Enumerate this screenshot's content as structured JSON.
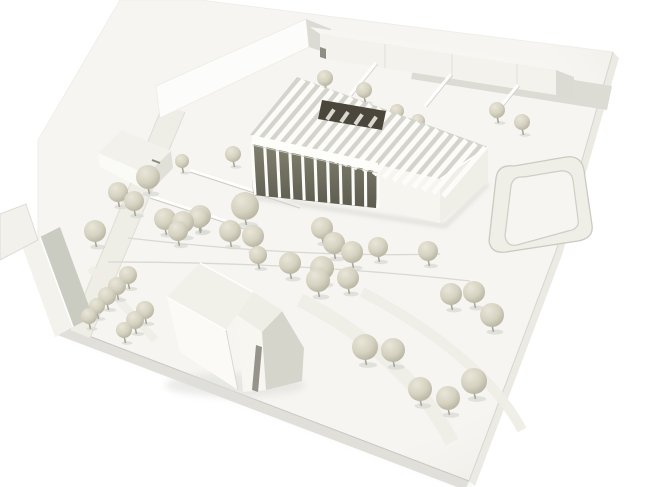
{
  "scene": {
    "kind": "photograph-of-white-architectural-site-model",
    "palette": {
      "background": "#ffffff",
      "board": "#f6f5f1",
      "board_edge_right": "#ebeae3",
      "board_edge_bottom": "#e0dfda",
      "board_edge_left": "#e6e5df",
      "board_line": "#c9c8c3",
      "shadow": "#cfcfca",
      "white_face": "#fafaf7",
      "lit_face": "#fcfcfa",
      "shaded_face": "#e9e8e1",
      "gray_face": "#dbdad3",
      "dark_gray_face": "#cbccc1",
      "glass_top": "#83826f",
      "glass_bottom": "#5c5b4f",
      "opening": "#4a463c",
      "tooth": "#d9d8d0",
      "road": "#dcdbd4",
      "path": "#eeede6",
      "path_line": "#d9d8d1",
      "louver": "#fcfcf9",
      "louver_gap": "#d5d4cc",
      "curb": "#e0dfd8",
      "trunk": "#a8a69a",
      "tree_shadow": "#dadad4",
      "tree_light": "#e9e6d9",
      "tree_mid": "#d5d2c1",
      "tree_dark": "#b1ae9b",
      "slot_dark": "#96948a",
      "window_slot": "#8a897e"
    },
    "board": {
      "top": [
        [
          200,
          0
        ],
        [
          613,
          52
        ],
        [
          556,
          251
        ],
        [
          469,
          481
        ],
        [
          60,
          325
        ],
        [
          38,
          260
        ],
        [
          38,
          140
        ],
        [
          120,
          0
        ]
      ],
      "bottom_face": [
        [
          60,
          325
        ],
        [
          469,
          481
        ],
        [
          465,
          490
        ],
        [
          55,
          334
        ]
      ],
      "right_face": [
        [
          613,
          52
        ],
        [
          556,
          251
        ],
        [
          469,
          481
        ],
        [
          475,
          486
        ],
        [
          562,
          255
        ],
        [
          619,
          58
        ]
      ],
      "left_face": [
        [
          38,
          260
        ],
        [
          60,
          325
        ],
        [
          55,
          334
        ],
        [
          33,
          269
        ]
      ],
      "bottom_edge_line": [
        [
          60,
          325
        ],
        [
          469,
          481
        ]
      ],
      "right_edge_line": [
        [
          613,
          52
        ],
        [
          556,
          251
        ],
        [
          469,
          481
        ]
      ],
      "drop_shadow": "M 60 328 L 469 484"
    },
    "roads": {
      "top_band": [
        [
          416,
          55
        ],
        [
          612,
          86
        ],
        [
          607,
          110
        ],
        [
          411,
          79
        ]
      ],
      "left_band": [
        [
          163,
          105
        ],
        [
          185,
          112
        ],
        [
          90,
          338
        ],
        [
          70,
          330
        ]
      ],
      "loop_outer": "M 489 241 L 496 178 Q 498 164 514 166 L 566 157 Q 581 155 584 170 L 592 225 Q 594 238 578 241 L 506 252 Q 491 254 489 241 Z",
      "loop_inner": "M 505 236 L 511 186 Q 513 176 524 177 L 560 171 Q 571 170 573 180 L 578 219 Q 580 229 568 231 L 517 245 Q 507 247 505 236 Z"
    },
    "paths": {
      "bands": [
        {
          "d": "M 300 300 C 360 330 420 380 452 442",
          "w": 14
        },
        {
          "d": "M 362 292 C 420 322 492 372 522 430",
          "w": 10
        },
        {
          "d": "M 90 268 L 155 340",
          "w": 8
        }
      ],
      "lines": [
        {
          "d": "M 128 238 Q 300 258 440 254"
        },
        {
          "d": "M 108 262 Q 300 262 470 281"
        }
      ],
      "ramps": [
        [
          190,
          170,
          300,
          206
        ],
        [
          150,
          196,
          260,
          232
        ]
      ]
    },
    "buildings": {
      "slab1": {
        "roof": [
          [
            146,
            80
          ],
          [
            296,
            13
          ],
          [
            306,
            19
          ],
          [
            156,
            86
          ]
        ],
        "front": [
          [
            156,
            86
          ],
          [
            306,
            19
          ],
          [
            309,
            47
          ],
          [
            160,
            118
          ]
        ],
        "end": [
          [
            306,
            19
          ],
          [
            331,
            29
          ],
          [
            333,
            55
          ],
          [
            309,
            47
          ]
        ]
      },
      "slab2": {
        "roof": [
          [
            310,
            27
          ],
          [
            546,
            63
          ],
          [
            556,
            70
          ],
          [
            320,
            34
          ]
        ],
        "front": [
          [
            320,
            34
          ],
          [
            556,
            70
          ],
          [
            556,
            95
          ],
          [
            320,
            58
          ]
        ],
        "end": [
          [
            556,
            70
          ],
          [
            574,
            77
          ],
          [
            574,
            99
          ],
          [
            556,
            95
          ]
        ],
        "joints": [
          [
            385,
            44,
            385,
            68
          ],
          [
            452,
            54,
            452,
            78
          ],
          [
            517,
            64,
            517,
            88
          ]
        ],
        "chimney": [
          [
            320,
            47
          ],
          [
            326,
            49
          ],
          [
            326,
            59
          ],
          [
            320,
            57
          ]
        ]
      },
      "bay_walls": [
        [
          376,
          63,
          350,
          95
        ],
        [
          451,
          74,
          425,
          106
        ],
        [
          518,
          85,
          492,
          117
        ]
      ],
      "house_hipped": {
        "roof_nw": [
          [
            98,
            153
          ],
          [
            122,
            130
          ],
          [
            171,
            151
          ],
          [
            147,
            174
          ]
        ],
        "roof_sw": [
          [
            98,
            153
          ],
          [
            147,
            174
          ],
          [
            143,
            189
          ],
          [
            100,
            167
          ]
        ],
        "face_se": [
          [
            147,
            174
          ],
          [
            171,
            151
          ],
          [
            173,
            168
          ],
          [
            149,
            193
          ]
        ],
        "window": [
          152,
          160,
          160,
          163
        ]
      },
      "house_gabled": {
        "roof_se": [
          [
            40,
            237
          ],
          [
            60,
            227
          ],
          [
            93,
            317
          ],
          [
            73,
            327
          ]
        ],
        "roof_nw": [
          [
            22,
            246
          ],
          [
            40,
            237
          ],
          [
            73,
            327
          ],
          [
            55,
            337
          ]
        ],
        "ridge": [
          40,
          237,
          73,
          327
        ]
      },
      "house_corner": {
        "body": [
          [
            0,
            214
          ],
          [
            26,
            204
          ],
          [
            38,
            240
          ],
          [
            0,
            260
          ]
        ]
      },
      "church": {
        "roof_nw": [
          [
            167,
            297
          ],
          [
            200,
            263
          ],
          [
            253,
            292
          ],
          [
            226,
            330
          ]
        ],
        "roof_sw": [
          [
            167,
            297
          ],
          [
            226,
            330
          ],
          [
            238,
            390
          ],
          [
            180,
            352
          ]
        ],
        "roof_r": [
          [
            253,
            292
          ],
          [
            282,
            310
          ],
          [
            262,
            332
          ],
          [
            237,
            315
          ]
        ],
        "gable_r": [
          [
            237,
            315
          ],
          [
            262,
            332
          ],
          [
            268,
            390
          ],
          [
            243,
            392
          ]
        ],
        "face_e": [
          [
            282,
            311
          ],
          [
            304,
            348
          ],
          [
            302,
            381
          ],
          [
            266,
            390
          ],
          [
            262,
            332
          ]
        ],
        "slot": [
          [
            256,
            345
          ],
          [
            262,
            347
          ],
          [
            258,
            392
          ],
          [
            252,
            390
          ]
        ],
        "ridge1": [
          200,
          263,
          253,
          292
        ],
        "ridge2": [
          167,
          297,
          226,
          330
        ],
        "crease": [
          226,
          330,
          238,
          390
        ]
      },
      "main": {
        "end_face": [
          [
            440,
            179
          ],
          [
            488,
            147
          ],
          [
            488,
            182
          ],
          [
            440,
            223
          ]
        ],
        "wall": [
          [
            378,
            165
          ],
          [
            440,
            179
          ],
          [
            440,
            223
          ],
          [
            376,
            208
          ]
        ],
        "glass": [
          [
            252,
            142
          ],
          [
            378,
            169
          ],
          [
            376,
            208
          ],
          [
            253,
            195
          ]
        ],
        "glass_top": [
          [
            252,
            142
          ],
          [
            378,
            169
          ]
        ],
        "glass_bottom": [
          [
            253,
            195
          ],
          [
            376,
            208
          ]
        ],
        "column_count": 11,
        "roof_bg": [
          [
            250,
            135
          ],
          [
            297,
            77
          ],
          [
            488,
            147
          ],
          [
            440,
            179
          ]
        ],
        "eave_front": [
          [
            250,
            136
          ],
          [
            448,
            198
          ]
        ],
        "eave_back": [
          [
            299,
            78
          ],
          [
            490,
            149
          ]
        ],
        "fin_count": 20,
        "fin_width": 5.2,
        "fascia": [
          [
            252,
            135
          ],
          [
            378,
            163
          ],
          [
            378,
            172
          ],
          [
            252,
            144
          ]
        ],
        "opening": [
          [
            318,
            119
          ],
          [
            322,
            100
          ],
          [
            386,
            111
          ],
          [
            382,
            130
          ]
        ],
        "opening_bottom": [
          [
            318,
            119
          ],
          [
            382,
            130
          ]
        ],
        "teeth_t": [
          0.14,
          0.36,
          0.58,
          0.8
        ],
        "base_shadow": "M 253 197 L 445 226 L 488 184"
      }
    },
    "trees": {
      "behind": [
        [
          325,
          78,
          8
        ],
        [
          364,
          90,
          8
        ],
        [
          397,
          111,
          7
        ],
        [
          418,
          121,
          7
        ],
        [
          497,
          110,
          8
        ],
        [
          522,
          122,
          8
        ]
      ],
      "front": [
        [
          182,
          161,
          7
        ],
        [
          233,
          154,
          8
        ],
        [
          148,
          177,
          12
        ],
        [
          118,
          192,
          10
        ],
        [
          134,
          201,
          10
        ],
        [
          245,
          206,
          14
        ],
        [
          200,
          216,
          11
        ],
        [
          199,
          218,
          10
        ],
        [
          165,
          219,
          11
        ],
        [
          183,
          222,
          11
        ],
        [
          322,
          228,
          11
        ],
        [
          95,
          231,
          11
        ],
        [
          178,
          231,
          10
        ],
        [
          230,
          231,
          11
        ],
        [
          253,
          236,
          11
        ],
        [
          334,
          243,
          11
        ],
        [
          378,
          247,
          10
        ],
        [
          428,
          251,
          10
        ],
        [
          352,
          252,
          11
        ],
        [
          258,
          255,
          9
        ],
        [
          290,
          263,
          11
        ],
        [
          322,
          268,
          12
        ],
        [
          128,
          275,
          9
        ],
        [
          348,
          278,
          11
        ],
        [
          318,
          280,
          12
        ],
        [
          117,
          286,
          9
        ],
        [
          474,
          292,
          11
        ],
        [
          451,
          294,
          11
        ],
        [
          107,
          296,
          9
        ],
        [
          97,
          306,
          8
        ],
        [
          145,
          310,
          9
        ],
        [
          492,
          315,
          12
        ],
        [
          89,
          316,
          8
        ],
        [
          135,
          320,
          9
        ],
        [
          124,
          330,
          8
        ],
        [
          365,
          347,
          13
        ],
        [
          393,
          350,
          12
        ],
        [
          474,
          381,
          13
        ],
        [
          420,
          389,
          12
        ],
        [
          448,
          398,
          12
        ]
      ]
    }
  }
}
